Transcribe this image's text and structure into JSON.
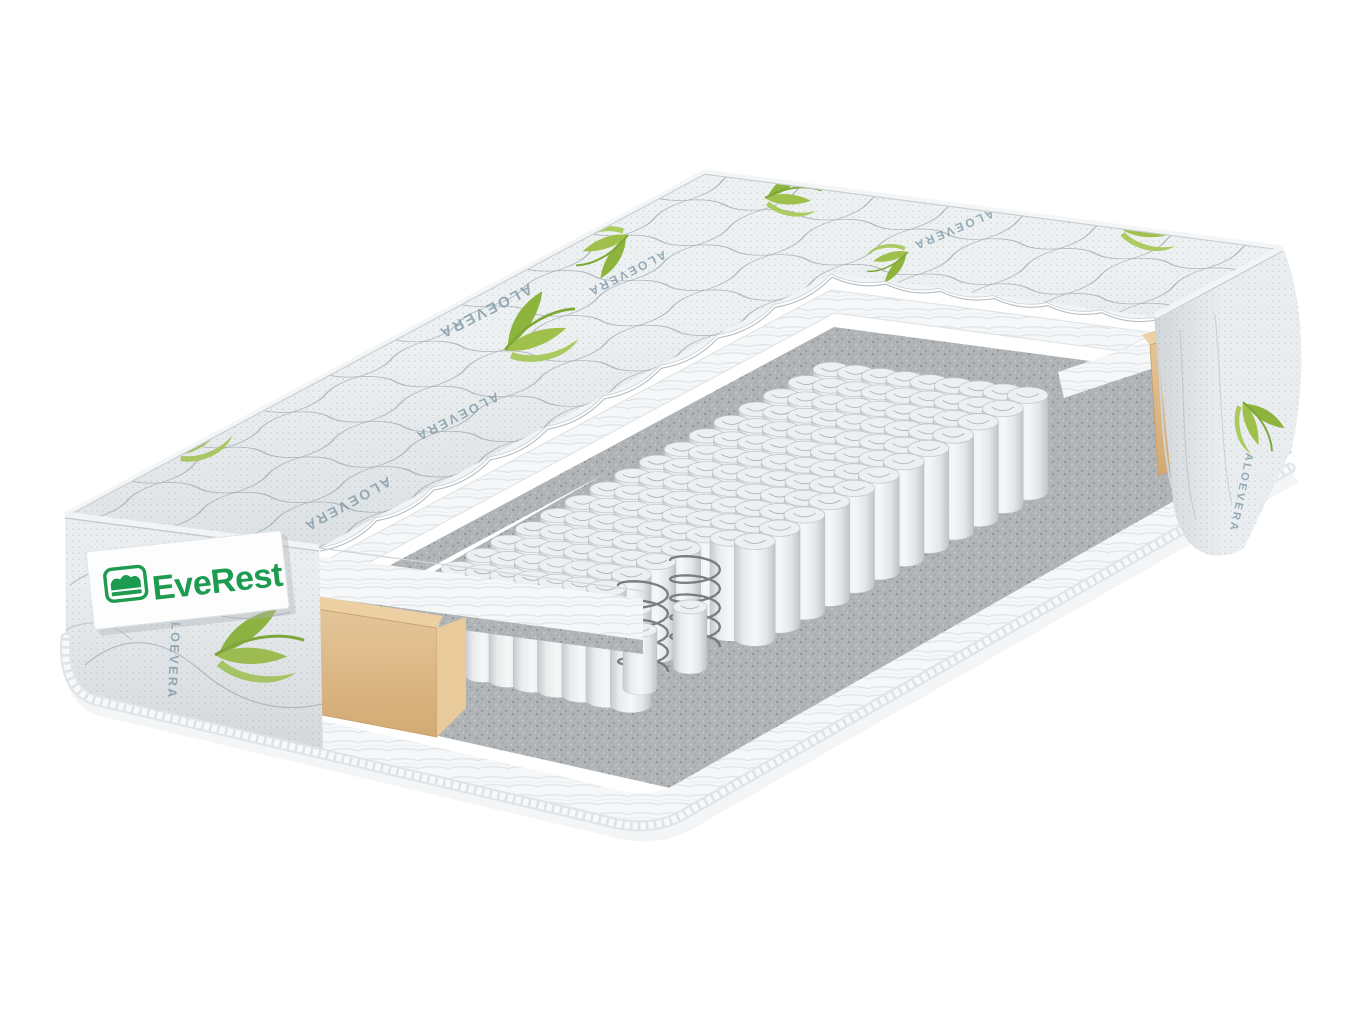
{
  "scene": {
    "type": "product-render",
    "description": "3D cutaway render of a pocket-spring mattress with quilted aloe vera cover",
    "background_color": "#ffffff"
  },
  "brand": {
    "name": "EveRest",
    "logo_color": "#1d9b50",
    "label_background": "#fdfdfd",
    "icon": "bed-logo-icon"
  },
  "fabric": {
    "pattern_text": "ALOEVERA",
    "pattern_text_color": "#7f99a7",
    "leaf_color": "#a6c64e",
    "base_color": "#eef1f2",
    "stitch_color": "#9aa5ad"
  },
  "layers": {
    "quilted_cover": {
      "label": "quilted aloe vera cover",
      "color": "#eef1f2"
    },
    "fiber_padding": {
      "label": "white fiber padding",
      "color": "#f5f7f8"
    },
    "felt": {
      "label": "felt insulator pad",
      "color": "#b0b4b7"
    },
    "pocket_springs": {
      "label": "independent pocket springs",
      "color": "#e9ebec",
      "cols": 17,
      "rows": 9
    },
    "steel_coils": {
      "label": "steel coil springs",
      "color": "#6f747a"
    },
    "foam_frame": {
      "label": "foam side frame",
      "color": "#ddb988"
    },
    "piping": {
      "label": "edge piping cord",
      "color": "#f6f8f9"
    }
  }
}
